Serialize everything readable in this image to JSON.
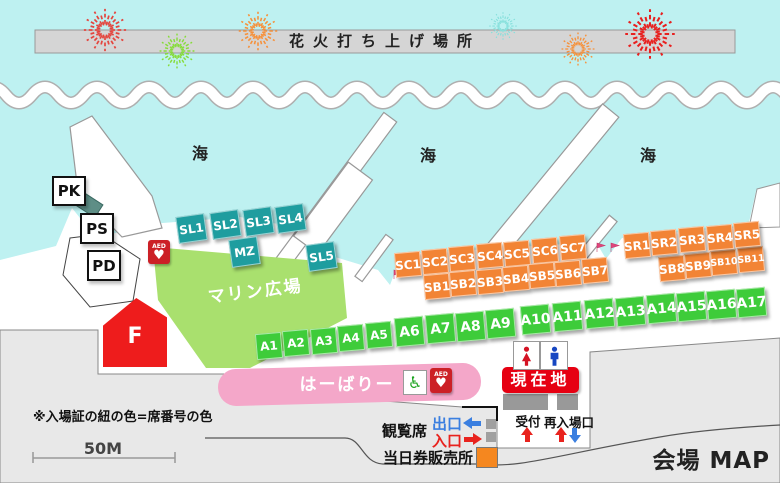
{
  "title": "会場 MAP",
  "launch_site_label": "花火打ち上げ場所",
  "sea_labels": [
    "海",
    "海",
    "海"
  ],
  "note": "※入場証の紐の色=席番号の色",
  "scale_label": "50M",
  "areas": {
    "marine_plaza": "マリン広場",
    "harbary": "はーばりー",
    "f_block": "F",
    "current_location": "現在地"
  },
  "facilities": {
    "pk": "PK",
    "ps": "PS",
    "pd": "PD",
    "reception": "受付",
    "reentry_gate": "再入場口",
    "aed": "AED",
    "wheelchair_icon": "♿",
    "heart_icon": "♥"
  },
  "legend": {
    "viewing_seats": "観覧席",
    "exit": "出口",
    "entrance": "入口",
    "same_day_tickets": "当日券販売所"
  },
  "seats": {
    "sl": [
      "SL1",
      "SL2",
      "SL3",
      "SL4",
      "SL5"
    ],
    "mz": "MZ",
    "sc": [
      "SC1",
      "SC2",
      "SC3",
      "SC4",
      "SC5",
      "SC6",
      "SC7"
    ],
    "sb": [
      "SB1",
      "SB2",
      "SB3",
      "SB4",
      "SB5",
      "SB6",
      "SB7",
      "SB8",
      "SB9",
      "SB10",
      "SB11"
    ],
    "sr": [
      "SR1",
      "SR2",
      "SR3",
      "SR4",
      "SR5"
    ],
    "a": [
      "A1",
      "A2",
      "A3",
      "A4",
      "A5",
      "A6",
      "A7",
      "A8",
      "A9",
      "A10",
      "A11",
      "A12",
      "A13",
      "A14",
      "A15",
      "A16",
      "A17"
    ]
  },
  "colors": {
    "sea": "#BEF1F1",
    "land": "#E8E8E8",
    "seat_teal": "#1F9D9F",
    "seat_orange": "#F28435",
    "seat_green": "#3ECC3A",
    "plaza_green": "#A9E06E",
    "harbary_pink": "#F4A7C9",
    "accent_red": "#E60012",
    "gate_blue": "#3B7FE0"
  }
}
